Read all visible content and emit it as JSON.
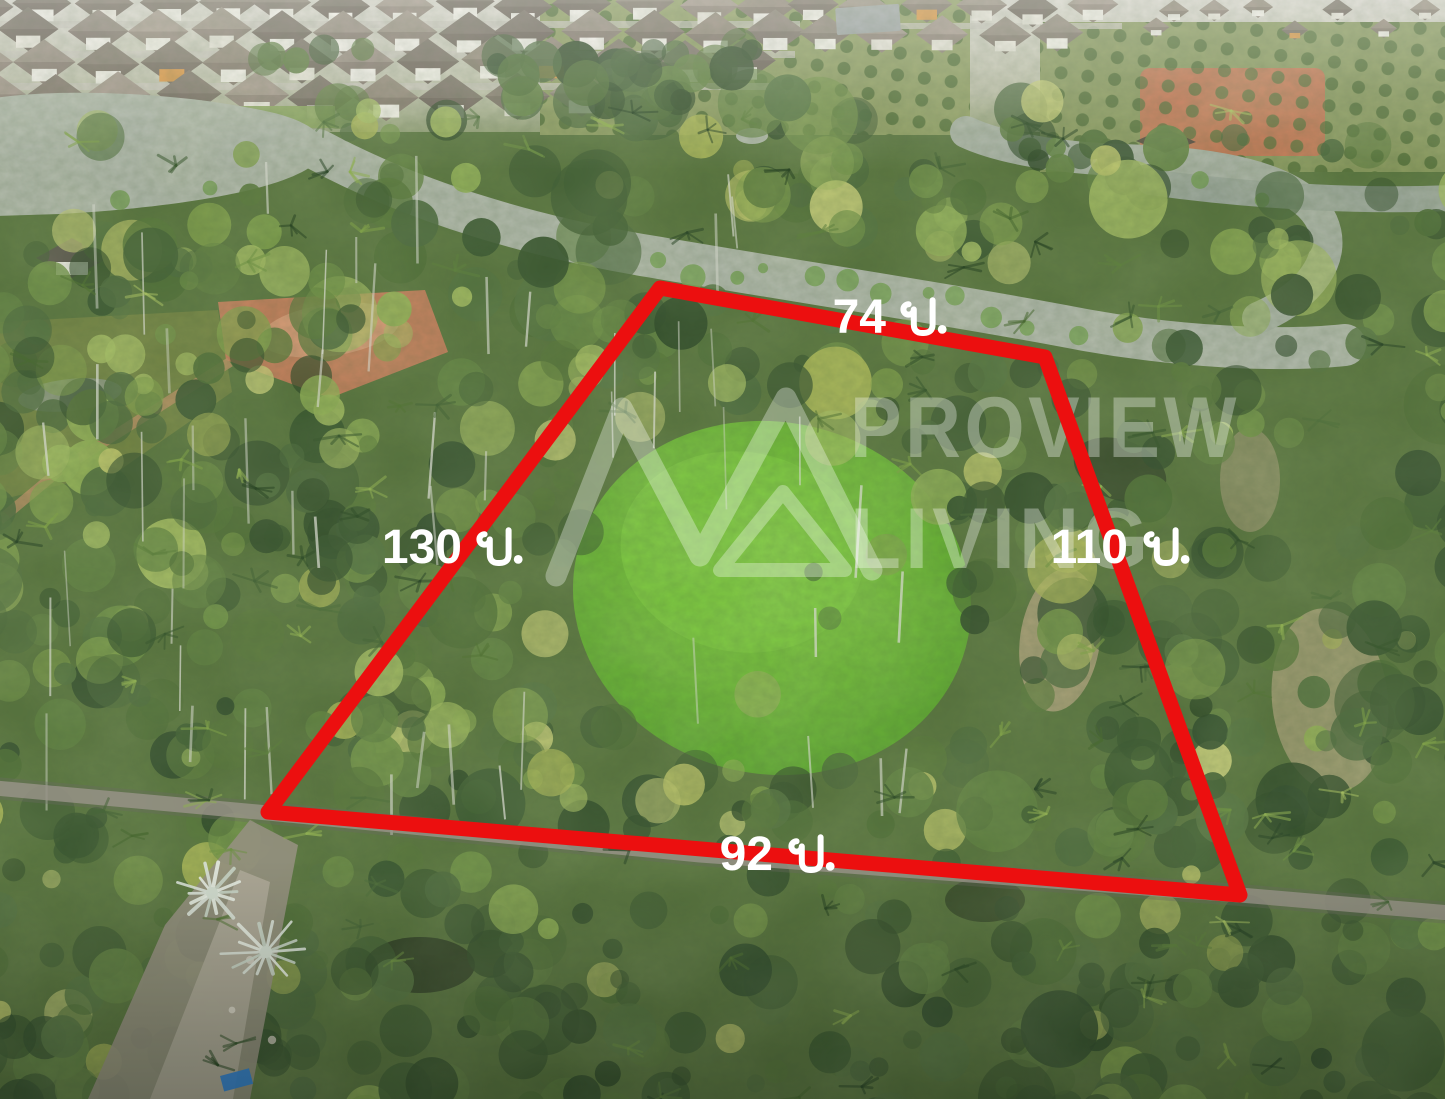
{
  "scene": {
    "description": "Aerial drone photo of a land plot for sale, outlined in red, surrounded by coconut and oil palm plantations, a winding river and a housing estate at the top"
  },
  "boundary": {
    "color": "#ec0f0f",
    "label_color": "#ffffff",
    "sides": [
      {
        "position": "top",
        "value": "74",
        "unit": "ม.",
        "label": "74 ม."
      },
      {
        "position": "left",
        "value": "130",
        "unit": "ม.",
        "label": "130 ม."
      },
      {
        "position": "right",
        "value": "110",
        "unit": "ม.",
        "label": "110 ม."
      },
      {
        "position": "bottom",
        "value": "92",
        "unit": "ม.",
        "label": "92 ม."
      }
    ]
  },
  "watermark": {
    "line1": "PROVIEW",
    "line2": "LIVING",
    "color": "#ffffff",
    "opacity": "0.33"
  }
}
